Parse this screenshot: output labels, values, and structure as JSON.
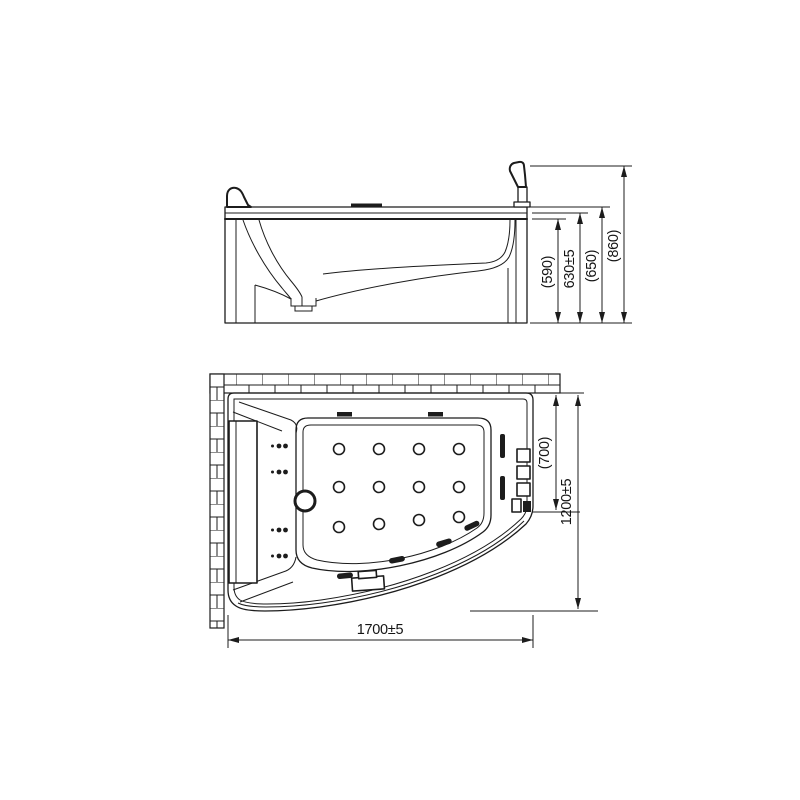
{
  "drawing": {
    "kind": "technical-drawing",
    "subject": "whirlpool offset-corner bathtub, front elevation and plan view",
    "views": [
      {
        "id": "side",
        "name": "front elevation"
      },
      {
        "id": "plan",
        "name": "plan view with wall hatch"
      }
    ],
    "features": [
      "headrest",
      "faucet-lever",
      "deck-plate",
      "drain-sump",
      "brick-wall-hatch-top",
      "brick-wall-hatch-left",
      "floor-jets-grid-12",
      "back-jet-dot-rows-4",
      "side-jet-bars-2",
      "front-rim-jets-4",
      "overflow-fitting",
      "control-buttons-3",
      "spout-fixture",
      "drain-circle"
    ]
  },
  "dims": {
    "side": {
      "inner_depth": "(590)",
      "rim_height": "630±5",
      "deck_height": "(650)",
      "total_height": "(860)"
    },
    "plan": {
      "inner_width": "(700)",
      "overall_width": "1200±5",
      "overall_length": "1700±5"
    }
  }
}
